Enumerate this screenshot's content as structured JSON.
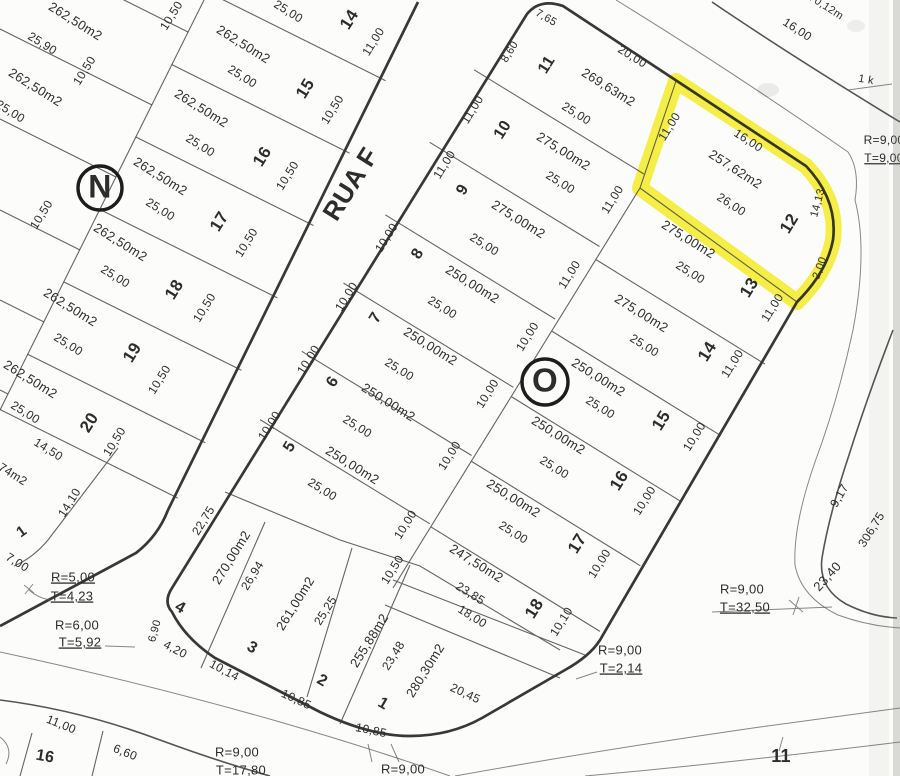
{
  "map": {
    "title": "cadastral-plat-scan",
    "street": {
      "name": "RUA F"
    },
    "highlight": {
      "lot": "12",
      "area": "257,62m2",
      "color": "#f3e81c"
    },
    "block_markers": [
      {
        "letter": "N",
        "x": 100,
        "y": 188,
        "r": 22
      },
      {
        "letter": "O",
        "x": 545,
        "y": 382,
        "r": 23
      }
    ],
    "labels": [
      {
        "t": "262,50m2",
        "x": 75,
        "y": 22,
        "r": 32,
        "s": 13,
        "k": "area"
      },
      {
        "t": "25,90",
        "x": 42,
        "y": 44,
        "r": 32,
        "s": 12
      },
      {
        "t": "10,50",
        "x": 172,
        "y": 16,
        "r": -58,
        "s": 12
      },
      {
        "t": "262,50m2",
        "x": 35,
        "y": 88,
        "r": 32,
        "s": 13,
        "k": "area"
      },
      {
        "t": "10,50",
        "x": 85,
        "y": 71,
        "r": -58,
        "s": 12
      },
      {
        "t": "25,00",
        "x": 10,
        "y": 112,
        "r": 32,
        "s": 12
      },
      {
        "t": "10,50",
        "x": 42,
        "y": 215,
        "r": -58,
        "s": 12
      },
      {
        "t": "25,00",
        "x": 288,
        "y": 12,
        "r": 32,
        "s": 12
      },
      {
        "t": "14",
        "x": 350,
        "y": 20,
        "r": -58,
        "s": 17,
        "k": "lot"
      },
      {
        "t": "11,00",
        "x": 374,
        "y": 42,
        "r": -58,
        "s": 12
      },
      {
        "t": "262,50m2",
        "x": 243,
        "y": 45,
        "r": 32,
        "s": 13,
        "k": "area"
      },
      {
        "t": "25,00",
        "x": 242,
        "y": 77,
        "r": 32,
        "s": 12
      },
      {
        "t": "15",
        "x": 306,
        "y": 89,
        "r": -58,
        "s": 17,
        "k": "lot"
      },
      {
        "t": "10,50",
        "x": 333,
        "y": 110,
        "r": -58,
        "s": 12
      },
      {
        "t": "262,50m2",
        "x": 201,
        "y": 109,
        "r": 32,
        "s": 13,
        "k": "area"
      },
      {
        "t": "25,00",
        "x": 200,
        "y": 146,
        "r": 32,
        "s": 12
      },
      {
        "t": "16",
        "x": 263,
        "y": 157,
        "r": -58,
        "s": 17,
        "k": "lot"
      },
      {
        "t": "10,50",
        "x": 288,
        "y": 176,
        "r": -58,
        "s": 12
      },
      {
        "t": "262,50m2",
        "x": 160,
        "y": 177,
        "r": 32,
        "s": 13,
        "k": "area"
      },
      {
        "t": "25,00",
        "x": 160,
        "y": 210,
        "r": 32,
        "s": 12
      },
      {
        "t": "17",
        "x": 220,
        "y": 222,
        "r": -58,
        "s": 17,
        "k": "lot"
      },
      {
        "t": "10,50",
        "x": 247,
        "y": 243,
        "r": -58,
        "s": 12
      },
      {
        "t": "262,50m2",
        "x": 120,
        "y": 243,
        "r": 32,
        "s": 13,
        "k": "area"
      },
      {
        "t": "25,00",
        "x": 115,
        "y": 277,
        "r": 32,
        "s": 12
      },
      {
        "t": "18",
        "x": 175,
        "y": 290,
        "r": -58,
        "s": 17,
        "k": "lot"
      },
      {
        "t": "10,50",
        "x": 205,
        "y": 308,
        "r": -58,
        "s": 12
      },
      {
        "t": "262,50m2",
        "x": 70,
        "y": 308,
        "r": 32,
        "s": 13,
        "k": "area"
      },
      {
        "t": "25,00",
        "x": 68,
        "y": 345,
        "r": 32,
        "s": 12
      },
      {
        "t": "19",
        "x": 133,
        "y": 353,
        "r": -58,
        "s": 17,
        "k": "lot"
      },
      {
        "t": "10,50",
        "x": 160,
        "y": 380,
        "r": -58,
        "s": 12
      },
      {
        "t": "262,50m2",
        "x": 30,
        "y": 380,
        "r": 32,
        "s": 13,
        "k": "area"
      },
      {
        "t": "25,00",
        "x": 25,
        "y": 413,
        "r": 32,
        "s": 12
      },
      {
        "t": "20",
        "x": 90,
        "y": 423,
        "r": -58,
        "s": 17,
        "k": "lot"
      },
      {
        "t": "10,50",
        "x": 115,
        "y": 442,
        "r": -58,
        "s": 12
      },
      {
        "t": "14,50",
        "x": 48,
        "y": 450,
        "r": 32,
        "s": 12
      },
      {
        "t": "7,74m2",
        "x": 8,
        "y": 472,
        "r": 32,
        "s": 12,
        "k": "area"
      },
      {
        "t": "14,10",
        "x": 70,
        "y": 503,
        "r": -58,
        "s": 12
      },
      {
        "t": "1",
        "x": 22,
        "y": 532,
        "r": -35,
        "s": 15,
        "k": "lot"
      },
      {
        "t": "7,00",
        "x": 17,
        "y": 563,
        "r": 32,
        "s": 12
      },
      {
        "t": "RUA F",
        "x": 352,
        "y": 185,
        "r": -58,
        "s": 26,
        "k": "street",
        "sp": 7
      },
      {
        "t": "R=5,00",
        "x": 73,
        "y": 578,
        "s": 13,
        "k": "radius",
        "u": 1
      },
      {
        "t": "T=4,23",
        "x": 72,
        "y": 597,
        "s": 13,
        "k": "radius",
        "u": 1
      },
      {
        "t": "R=6,00",
        "x": 77,
        "y": 626,
        "s": 13,
        "k": "radius"
      },
      {
        "t": "T=5,92",
        "x": 80,
        "y": 643,
        "s": 13,
        "k": "radius",
        "u": 1
      },
      {
        "t": "7,65",
        "x": 546,
        "y": 18,
        "r": 30,
        "s": 11
      },
      {
        "t": "8,60",
        "x": 510,
        "y": 52,
        "r": -58,
        "s": 11
      },
      {
        "t": "11",
        "x": 547,
        "y": 65,
        "r": -58,
        "s": 16,
        "k": "lot"
      },
      {
        "t": "20,00",
        "x": 632,
        "y": 57,
        "r": 32,
        "s": 12
      },
      {
        "t": "269,63m2",
        "x": 608,
        "y": 88,
        "r": 32,
        "s": 13,
        "k": "area"
      },
      {
        "t": "25,00",
        "x": 576,
        "y": 114,
        "r": 32,
        "s": 12
      },
      {
        "t": "11,00",
        "x": 473,
        "y": 110,
        "r": -58,
        "s": 12
      },
      {
        "t": "10",
        "x": 503,
        "y": 130,
        "r": -58,
        "s": 16,
        "k": "lot"
      },
      {
        "t": "275,00m2",
        "x": 563,
        "y": 152,
        "r": 32,
        "s": 13,
        "k": "area"
      },
      {
        "t": "25,00",
        "x": 560,
        "y": 183,
        "r": 32,
        "s": 12
      },
      {
        "t": "11,00",
        "x": 670,
        "y": 127,
        "r": -58,
        "s": 12
      },
      {
        "t": "11,00",
        "x": 445,
        "y": 165,
        "r": -58,
        "s": 12
      },
      {
        "t": "9",
        "x": 463,
        "y": 190,
        "r": -58,
        "s": 16,
        "k": "lot"
      },
      {
        "t": "275,00m2",
        "x": 518,
        "y": 220,
        "r": 32,
        "s": 13,
        "k": "area"
      },
      {
        "t": "25,00",
        "x": 484,
        "y": 245,
        "r": 32,
        "s": 12
      },
      {
        "t": "11,00",
        "x": 613,
        "y": 200,
        "r": -58,
        "s": 12
      },
      {
        "t": "10,00",
        "x": 387,
        "y": 238,
        "r": -58,
        "s": 12
      },
      {
        "t": "8",
        "x": 418,
        "y": 254,
        "r": -58,
        "s": 16,
        "k": "lot"
      },
      {
        "t": "250,00m2",
        "x": 472,
        "y": 285,
        "r": 32,
        "s": 13,
        "k": "area"
      },
      {
        "t": "25,00",
        "x": 442,
        "y": 308,
        "r": 32,
        "s": 12
      },
      {
        "t": "11,00",
        "x": 570,
        "y": 275,
        "r": -58,
        "s": 12
      },
      {
        "t": "10,00",
        "x": 347,
        "y": 297,
        "r": -58,
        "s": 12
      },
      {
        "t": "7",
        "x": 376,
        "y": 318,
        "r": -58,
        "s": 16,
        "k": "lot"
      },
      {
        "t": "250,00m2",
        "x": 430,
        "y": 347,
        "r": 32,
        "s": 13,
        "k": "area"
      },
      {
        "t": "25,00",
        "x": 399,
        "y": 370,
        "r": 32,
        "s": 12
      },
      {
        "t": "10,00",
        "x": 528,
        "y": 337,
        "r": -58,
        "s": 12
      },
      {
        "t": "10,00",
        "x": 309,
        "y": 360,
        "r": -58,
        "s": 12
      },
      {
        "t": "6",
        "x": 333,
        "y": 382,
        "r": -58,
        "s": 16,
        "k": "lot"
      },
      {
        "t": "250,00m2",
        "x": 388,
        "y": 403,
        "r": 32,
        "s": 13,
        "k": "area"
      },
      {
        "t": "25,00",
        "x": 357,
        "y": 427,
        "r": 32,
        "s": 12
      },
      {
        "t": "10,00",
        "x": 488,
        "y": 394,
        "r": -58,
        "s": 12
      },
      {
        "t": "10,00",
        "x": 270,
        "y": 426,
        "r": -58,
        "s": 12
      },
      {
        "t": "5",
        "x": 290,
        "y": 447,
        "r": -58,
        "s": 16,
        "k": "lot"
      },
      {
        "t": "250,00m2",
        "x": 352,
        "y": 466,
        "r": 32,
        "s": 13,
        "k": "area"
      },
      {
        "t": "25,00",
        "x": 322,
        "y": 490,
        "r": 32,
        "s": 12
      },
      {
        "t": "10,00",
        "x": 450,
        "y": 456,
        "r": -58,
        "s": 12
      },
      {
        "t": "10,00",
        "x": 406,
        "y": 525,
        "r": -58,
        "s": 12
      },
      {
        "t": "10,50",
        "x": 393,
        "y": 570,
        "r": -58,
        "s": 12
      },
      {
        "t": "16,00",
        "x": 748,
        "y": 141,
        "r": 33,
        "s": 12
      },
      {
        "t": "257,62m2",
        "x": 735,
        "y": 170,
        "r": 33,
        "s": 13,
        "k": "area"
      },
      {
        "t": "26,00",
        "x": 731,
        "y": 205,
        "r": 33,
        "s": 12
      },
      {
        "t": "12",
        "x": 790,
        "y": 224,
        "r": -58,
        "s": 17,
        "k": "lot"
      },
      {
        "t": "14,13",
        "x": 818,
        "y": 203,
        "r": -75,
        "s": 11
      },
      {
        "t": "2,00",
        "x": 820,
        "y": 268,
        "r": -70,
        "s": 11
      },
      {
        "t": "275,00m2",
        "x": 688,
        "y": 240,
        "r": 32,
        "s": 13,
        "k": "area"
      },
      {
        "t": "25,00",
        "x": 690,
        "y": 273,
        "r": 32,
        "s": 12
      },
      {
        "t": "13",
        "x": 750,
        "y": 288,
        "r": -58,
        "s": 17,
        "k": "lot"
      },
      {
        "t": "11,00",
        "x": 773,
        "y": 308,
        "r": -58,
        "s": 12
      },
      {
        "t": "275,00m2",
        "x": 641,
        "y": 314,
        "r": 32,
        "s": 13,
        "k": "area"
      },
      {
        "t": "25,00",
        "x": 644,
        "y": 346,
        "r": 32,
        "s": 12
      },
      {
        "t": "14",
        "x": 708,
        "y": 352,
        "r": -58,
        "s": 17,
        "k": "lot"
      },
      {
        "t": "11,00",
        "x": 733,
        "y": 364,
        "r": -58,
        "s": 12
      },
      {
        "t": "250,00m2",
        "x": 598,
        "y": 378,
        "r": 32,
        "s": 13,
        "k": "area"
      },
      {
        "t": "25,00",
        "x": 600,
        "y": 408,
        "r": 32,
        "s": 12
      },
      {
        "t": "15",
        "x": 662,
        "y": 421,
        "r": -58,
        "s": 17,
        "k": "lot"
      },
      {
        "t": "10,00",
        "x": 695,
        "y": 437,
        "r": -58,
        "s": 12
      },
      {
        "t": "250,00m2",
        "x": 558,
        "y": 436,
        "r": 32,
        "s": 13,
        "k": "area"
      },
      {
        "t": "25,00",
        "x": 554,
        "y": 468,
        "r": 32,
        "s": 12
      },
      {
        "t": "16",
        "x": 620,
        "y": 481,
        "r": -58,
        "s": 17,
        "k": "lot"
      },
      {
        "t": "10,00",
        "x": 645,
        "y": 501,
        "r": -58,
        "s": 12
      },
      {
        "t": "250,00m2",
        "x": 513,
        "y": 499,
        "r": 32,
        "s": 13,
        "k": "area"
      },
      {
        "t": "25,00",
        "x": 513,
        "y": 533,
        "r": 32,
        "s": 12
      },
      {
        "t": "17",
        "x": 578,
        "y": 544,
        "r": -58,
        "s": 17,
        "k": "lot"
      },
      {
        "t": "10,00",
        "x": 600,
        "y": 564,
        "r": -58,
        "s": 12
      },
      {
        "t": "247,50m2",
        "x": 476,
        "y": 564,
        "r": 32,
        "s": 13,
        "k": "area"
      },
      {
        "t": "23,85",
        "x": 470,
        "y": 594,
        "r": 32,
        "s": 12
      },
      {
        "t": "18,00",
        "x": 472,
        "y": 617,
        "r": 32,
        "s": 12
      },
      {
        "t": "18",
        "x": 535,
        "y": 609,
        "r": -58,
        "s": 17,
        "k": "lot"
      },
      {
        "t": "10,10",
        "x": 562,
        "y": 622,
        "r": -58,
        "s": 12
      },
      {
        "t": "22,75",
        "x": 204,
        "y": 521,
        "r": -58,
        "s": 12
      },
      {
        "t": "270,00m2",
        "x": 232,
        "y": 558,
        "r": -58,
        "s": 13,
        "k": "area"
      },
      {
        "t": "26,94",
        "x": 253,
        "y": 576,
        "r": -58,
        "s": 12
      },
      {
        "t": "4",
        "x": 180,
        "y": 608,
        "r": 30,
        "s": 16,
        "k": "lot"
      },
      {
        "t": "261,00m2",
        "x": 296,
        "y": 604,
        "r": -58,
        "s": 13,
        "k": "area"
      },
      {
        "t": "25,25",
        "x": 326,
        "y": 611,
        "r": -58,
        "s": 12
      },
      {
        "t": "3",
        "x": 252,
        "y": 648,
        "r": 30,
        "s": 16,
        "k": "lot"
      },
      {
        "t": "255,88m2",
        "x": 370,
        "y": 641,
        "r": -58,
        "s": 13,
        "k": "area"
      },
      {
        "t": "23,48",
        "x": 394,
        "y": 656,
        "r": -58,
        "s": 12
      },
      {
        "t": "2",
        "x": 322,
        "y": 681,
        "r": 30,
        "s": 16,
        "k": "lot"
      },
      {
        "t": "280,30m2",
        "x": 426,
        "y": 671,
        "r": -58,
        "s": 13,
        "k": "area"
      },
      {
        "t": "1",
        "x": 383,
        "y": 704,
        "r": 30,
        "s": 16,
        "k": "lot"
      },
      {
        "t": "20,45",
        "x": 465,
        "y": 694,
        "r": 25,
        "s": 12
      },
      {
        "t": "10,85",
        "x": 296,
        "y": 700,
        "r": 25,
        "s": 12
      },
      {
        "t": "10,85",
        "x": 371,
        "y": 731,
        "r": 12,
        "s": 12
      },
      {
        "t": "10,14",
        "x": 224,
        "y": 671,
        "r": 28,
        "s": 12
      },
      {
        "t": "4,20",
        "x": 175,
        "y": 650,
        "r": 28,
        "s": 12
      },
      {
        "t": "6,90",
        "x": 155,
        "y": 631,
        "r": -75,
        "s": 11
      },
      {
        "t": "R=9,00",
        "x": 620,
        "y": 651,
        "s": 13,
        "k": "radius"
      },
      {
        "t": "T=2,14",
        "x": 621,
        "y": 669,
        "s": 13,
        "k": "radius",
        "u": 1
      },
      {
        "t": "R=9,00",
        "x": 742,
        "y": 590,
        "s": 13,
        "k": "radius"
      },
      {
        "t": "T=32,50",
        "x": 745,
        "y": 608,
        "s": 13,
        "k": "radius",
        "u": 1
      },
      {
        "t": "R=9,00",
        "x": 237,
        "y": 753,
        "s": 13,
        "k": "radius"
      },
      {
        "t": "T=17,80",
        "x": 241,
        "y": 771,
        "s": 13,
        "k": "radius"
      },
      {
        "t": "R=9,00",
        "x": 403,
        "y": 770,
        "s": 13,
        "k": "radius"
      },
      {
        "t": "R=9,00",
        "x": 884,
        "y": 141,
        "s": 12,
        "k": "radius"
      },
      {
        "t": "T=9,00",
        "x": 884,
        "y": 159,
        "s": 12,
        "k": "radius",
        "u": 1
      },
      {
        "t": "16,00",
        "x": 797,
        "y": 30,
        "r": 33,
        "s": 12
      },
      {
        "t": "70,12m",
        "x": 826,
        "y": 7,
        "r": 33,
        "s": 11
      },
      {
        "t": "9,17",
        "x": 840,
        "y": 496,
        "r": -60,
        "s": 12
      },
      {
        "t": "23,40",
        "x": 828,
        "y": 577,
        "r": -48,
        "s": 13
      },
      {
        "t": "306,75",
        "x": 872,
        "y": 530,
        "r": -58,
        "s": 12,
        "c": "#b8b8b2"
      },
      {
        "t": "11",
        "x": 781,
        "y": 757,
        "s": 18,
        "k": "lot"
      },
      {
        "t": "11,00",
        "x": 61,
        "y": 725,
        "r": 22,
        "s": 12
      },
      {
        "t": "16",
        "x": 45,
        "y": 757,
        "r": 10,
        "s": 16,
        "k": "lot"
      },
      {
        "t": "6,60",
        "x": 125,
        "y": 753,
        "r": 22,
        "s": 12
      },
      {
        "t": "1 k",
        "x": 866,
        "y": 80,
        "r": 10,
        "s": 11,
        "c": "#4a4a4a"
      }
    ]
  }
}
